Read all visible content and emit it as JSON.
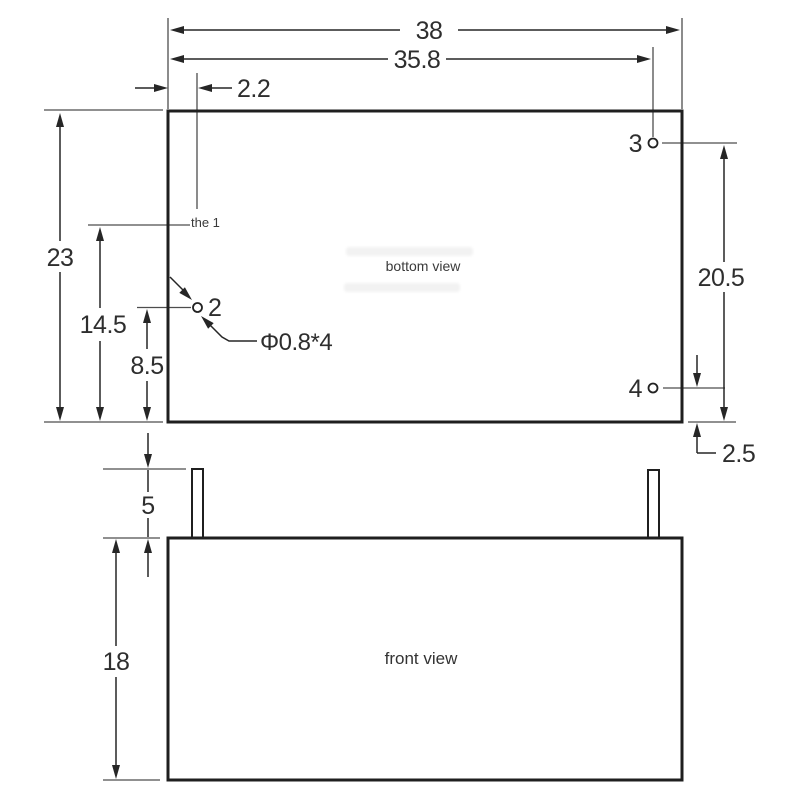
{
  "drawing": {
    "views": {
      "bottom_label": "bottom view",
      "front_label": "front view"
    },
    "dims": {
      "overall_width": "38",
      "pin_span_x": "35.8",
      "pin1_offset_x": "2.2",
      "overall_depth": "23",
      "pin1_offset_y": "14.5",
      "pin2_offset_y": "8.5",
      "pin_span_y": "20.5",
      "pin4_offset_y": "2.5",
      "pin_length": "5",
      "body_height": "18",
      "hole_callout": "Φ0.8*4"
    },
    "pins": {
      "pin1_label": "the 1",
      "pin2_label": "2",
      "pin3_label": "3",
      "pin4_label": "4"
    },
    "colors": {
      "background": "#ffffff",
      "outline": "#1f1f1f",
      "dimension_lines": "#262626",
      "extension_lines": "#4d4d4d",
      "text": "#2e2e2e"
    }
  }
}
